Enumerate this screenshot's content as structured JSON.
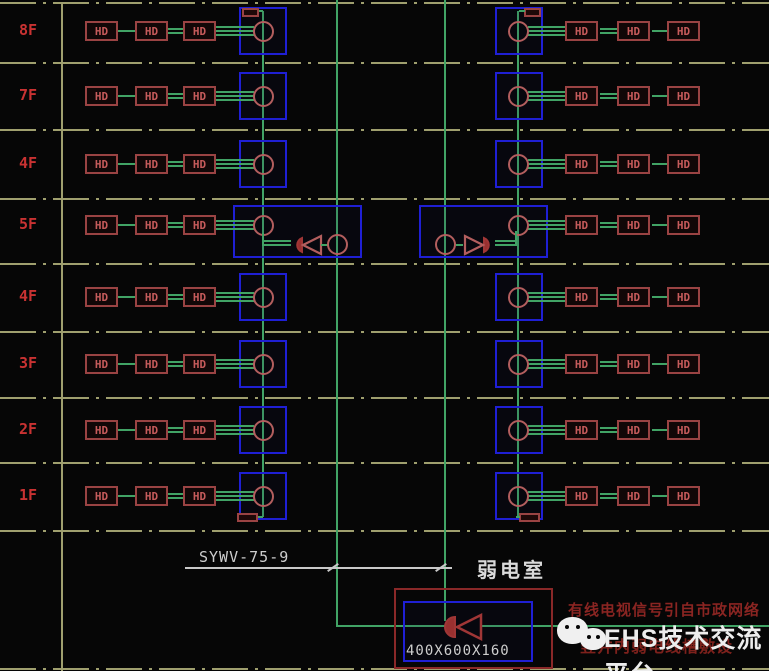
{
  "diagram": {
    "floors": [
      {
        "label": "8F",
        "top_terminal": true,
        "has_amplifiers": false,
        "bottom_terminal": false
      },
      {
        "label": "7F",
        "top_terminal": false,
        "has_amplifiers": false,
        "bottom_terminal": false
      },
      {
        "label": "4F",
        "top_terminal": false,
        "has_amplifiers": false,
        "bottom_terminal": false
      },
      {
        "label": "5F",
        "top_terminal": false,
        "has_amplifiers": true,
        "bottom_terminal": false
      },
      {
        "label": "4F",
        "top_terminal": false,
        "has_amplifiers": false,
        "bottom_terminal": false
      },
      {
        "label": "3F",
        "top_terminal": false,
        "has_amplifiers": false,
        "bottom_terminal": false
      },
      {
        "label": "2F",
        "top_terminal": false,
        "has_amplifiers": false,
        "bottom_terminal": false
      },
      {
        "label": "1F",
        "top_terminal": false,
        "has_amplifiers": false,
        "bottom_terminal": true
      }
    ],
    "device_label": "HD",
    "riser_cable_label": "SYWV-75-9",
    "room_label": "弱电室",
    "enclosure_size_label": "400X600X160",
    "notes": [
      "有线电视信号引自市政网络",
      "竖井内弱电线槽敷设"
    ],
    "watermark": {
      "icon": "wechat-icon",
      "text": "EHS技术交流平台"
    },
    "colors": {
      "background": "#060606",
      "line_green": "#41a365",
      "box_blue": "#1f1fd4",
      "device_red": "#9a4343",
      "device_text": "#c75b5b",
      "circle_red": "#b35e5e",
      "floor_text": "#c93232",
      "grid_olive": "#9f9f6e",
      "white_text": "#cfcfcf",
      "note_red": "#8a2522",
      "enclosure_red": "#8a2828",
      "watermark_white": "#ededed"
    }
  }
}
